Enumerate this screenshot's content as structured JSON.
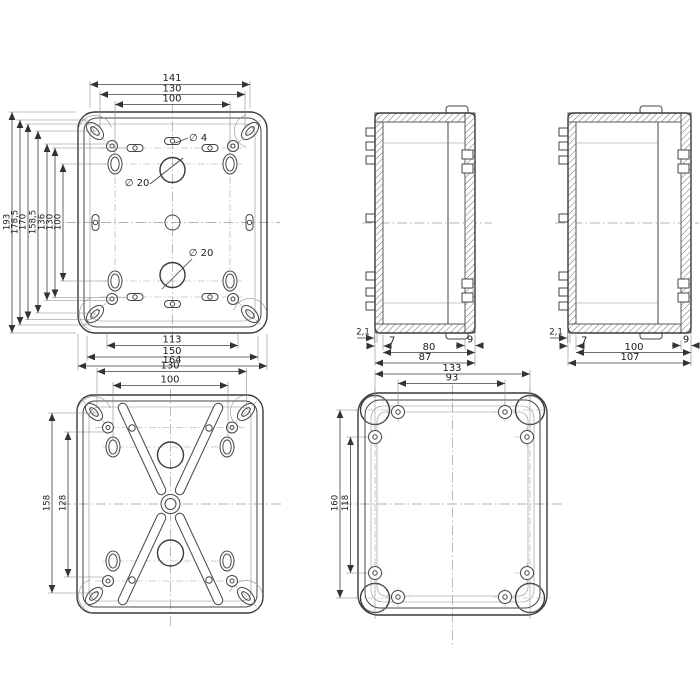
{
  "drawing_title": "enclosure-dimension-drawing",
  "colors": {
    "line": "#3a3a3a",
    "background": "#ffffff",
    "centerline": "#9c9c9c"
  },
  "front_view": {
    "dims_top": [
      "141",
      "130",
      "100"
    ],
    "dims_left": [
      "193",
      "178,5",
      "170",
      "158,5",
      "136",
      "130",
      "100"
    ],
    "dims_bottom": [
      "113",
      "150",
      "164"
    ],
    "labels": {
      "small_hole": "∅ 4",
      "top_hole": "∅ 20",
      "bottom_hole": "∅ 20"
    }
  },
  "side_small": {
    "lip": "2,1",
    "wall": "7",
    "depth": "80",
    "lid": "9",
    "total": "87"
  },
  "side_large": {
    "lip": "2,1",
    "wall": "7",
    "depth": "100",
    "lid": "9",
    "total": "107"
  },
  "back_view": {
    "dims_top": [
      "130",
      "100"
    ],
    "dims_left": [
      "158",
      "128"
    ]
  },
  "cover_view": {
    "dims_top": [
      "133",
      "93"
    ],
    "dims_left": [
      "160",
      "118"
    ]
  }
}
